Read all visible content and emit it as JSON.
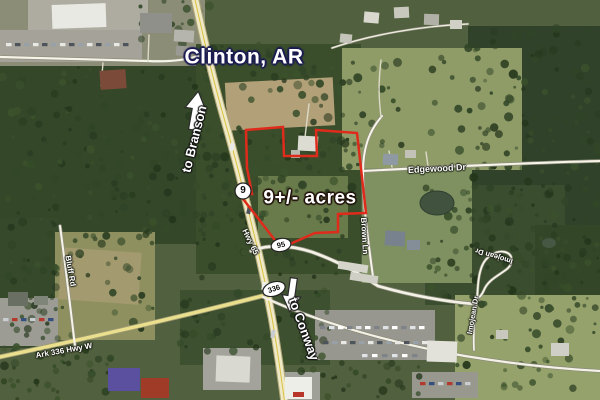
{
  "map": {
    "title": "Clinton, AR",
    "parcel": {
      "acreage_label": "9+/- acres",
      "outline_color": "#df2b1b"
    },
    "directions": {
      "north_label": "to Branson",
      "south_label": "to Conway"
    },
    "roads": {
      "hwy65": "Hwy 65",
      "edgewood": "Edgewood Dr",
      "brown_ln": "Brown Ln",
      "imojean_upper": "Imojean Dr",
      "imojean_lower": "Imojean Dr",
      "bluff": "Bluff Rd",
      "ark336": "Ark 336 Hwy W"
    },
    "shields": {
      "ar9": "9",
      "ar95": "95",
      "ar336": "336"
    },
    "colors": {
      "parcel_outline": "#df2b1b",
      "city_text": "#ffffff",
      "city_halo": "#1b1b52",
      "label_text": "#ffffff"
    }
  }
}
